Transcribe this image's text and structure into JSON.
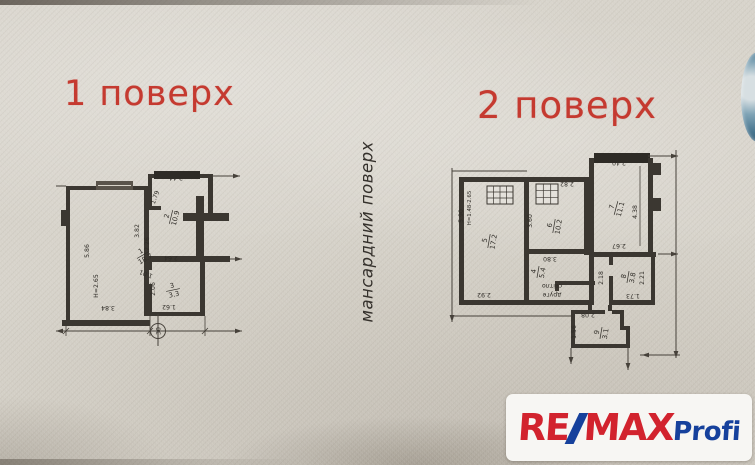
{
  "titles": {
    "floor1": "1 поверх",
    "floor2": "2 поверх",
    "side": "мансардний поверх"
  },
  "plan1": {
    "rooms": [
      {
        "num": "1",
        "area": "18.7"
      },
      {
        "num": "2",
        "area": "10.9"
      },
      {
        "num": "3",
        "area": "3.3"
      }
    ],
    "dims": {
      "d244": "2.44",
      "d179": "1.79",
      "d382": "3.82",
      "d226": "2.26",
      "d264": "2.64",
      "d101": "1.01",
      "d206": "2.06",
      "d162": "1.62",
      "d384": "3.84",
      "d586": "5.86",
      "height": "H=2.65"
    },
    "marker": "30"
  },
  "plan2": {
    "rooms": [
      {
        "num": "5",
        "area": "17.2"
      },
      {
        "num": "6",
        "area": "10.2"
      },
      {
        "num": "7",
        "area": "11.1"
      },
      {
        "num": "4",
        "area": "5.4"
      },
      {
        "num": "8",
        "area": "3.8"
      },
      {
        "num": "9",
        "area": "3.1"
      }
    ],
    "dims": {
      "d590": "5.90",
      "height": "H=1.48-2.65",
      "d292": "2.92",
      "d360": "3.60",
      "d282": "2.82",
      "d240": "2.40",
      "d438": "4.38",
      "d267": "2.67",
      "d380": "3.80",
      "d218": "2.18",
      "d221": "2.21",
      "d173": "1.73",
      "d208": "2.08",
      "d156": "1.56"
    },
    "note": {
      "line1": "друге",
      "line2": "світло"
    }
  },
  "logo": {
    "re": "RE",
    "slash": "/",
    "max": "MAX",
    "suffix": "Profi"
  },
  "colors": {
    "title_red": "#c53a30",
    "logo_red": "#d2232e",
    "logo_blue": "#16419c",
    "ink": "#2f2c27"
  }
}
